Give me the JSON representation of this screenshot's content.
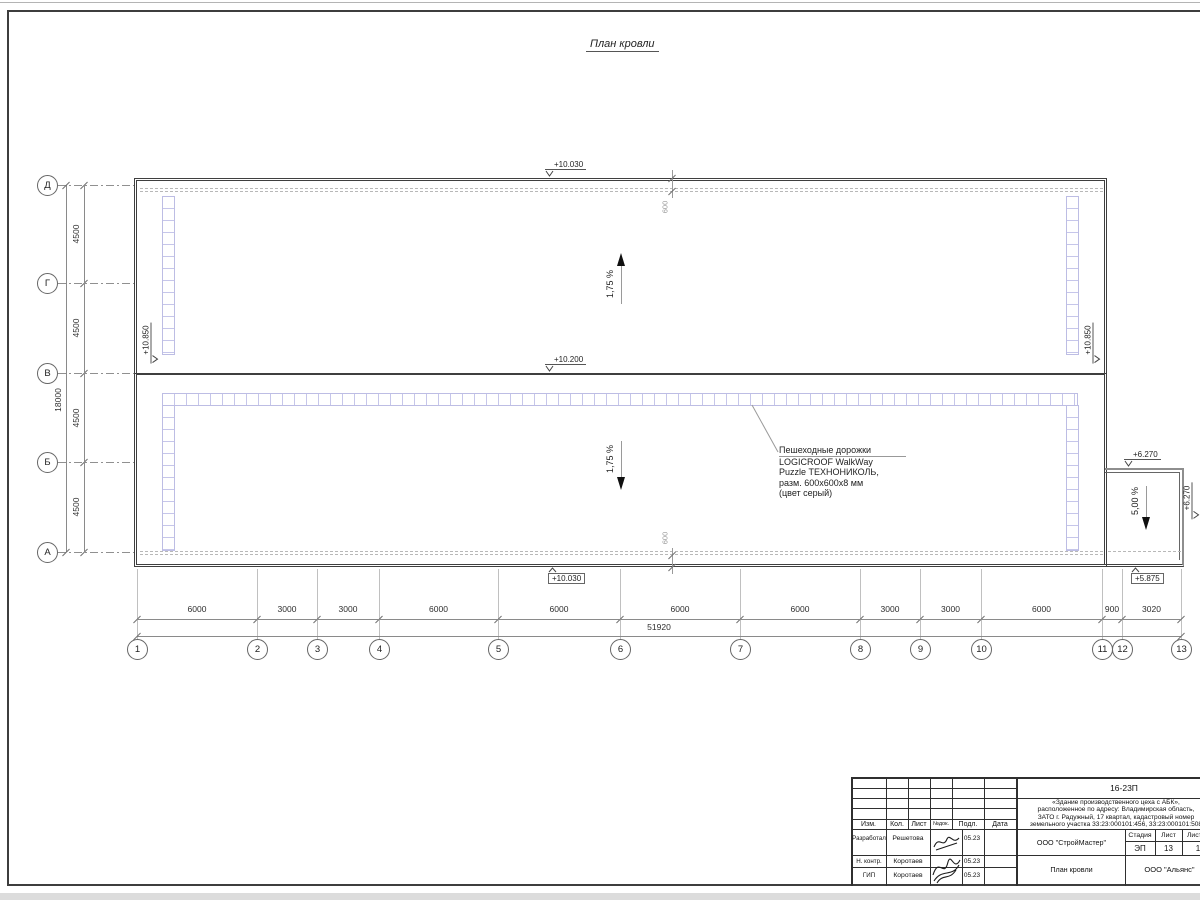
{
  "page": {
    "title": "План кровли"
  },
  "elevations": {
    "roof_top": "+10.030",
    "ridge": "+10.200",
    "parapet_left": "+10.850",
    "parapet_right": "+10.850",
    "annex_top": "+6.270",
    "annex_right": "+6.270",
    "roof_bottom": "+10.030",
    "annex_bottom": "+5.875"
  },
  "slopes": {
    "upper": "1,75 %",
    "lower": "1,75 %",
    "annex": "5,00 %"
  },
  "offsets": {
    "top": "600",
    "bottom": "600"
  },
  "walkway_note": {
    "line1": "Пешеходные дорожки",
    "line2": "LOGICROOF WalkWay",
    "line3": "Puzzle ТЕХНОНИКОЛЬ,",
    "line4": "разм. 600x600x8 мм",
    "line5": "(цвет серый)"
  },
  "axes": {
    "rows": [
      "Д",
      "Г",
      "В",
      "Б",
      "А"
    ],
    "row_dims": [
      "4500",
      "4500",
      "4500",
      "4500"
    ],
    "row_total": "18000",
    "cols": [
      "1",
      "2",
      "3",
      "4",
      "5",
      "6",
      "7",
      "8",
      "9",
      "10",
      "11",
      "12",
      "13"
    ],
    "col_dims": [
      "6000",
      "3000",
      "3000",
      "6000",
      "6000",
      "6000",
      "6000",
      "3000",
      "3000",
      "6000",
      "900",
      "3020"
    ],
    "col_total": "51920"
  },
  "titleblock": {
    "doc_number": "16-23П",
    "project_line1": "«Здание производственного цеха с АБК»,",
    "project_line2": "расположенное по адресу: Владимирская область,",
    "project_line3": "ЗАТО г. Радужный, 17 квартал, кадастровый номер",
    "project_line4": "земельного участка 33:23:000101:456, 33:23:000101:508",
    "header": {
      "izm": "Изм.",
      "kol": "Кол.",
      "list": "Лист",
      "ndok": "№док.",
      "podl": "Подл.",
      "data": "Дата"
    },
    "rows": [
      {
        "role": "Разработал",
        "name": "Решетова",
        "date": "05.23"
      },
      {
        "role": "Н. контр.",
        "name": "Коротаев",
        "date": "05.23"
      },
      {
        "role": "ГИП",
        "name": "Коротаев",
        "date": "05.23"
      }
    ],
    "org1": "ООО \"СтройМастер\"",
    "stage_label": "Стадия",
    "sheet_label": "Лист",
    "sheets_label": "Листов",
    "stage": "ЭП",
    "sheet": "13",
    "sheets": "1",
    "drawing_title": "План кровли",
    "org2": "ООО \"Альянс\""
  }
}
